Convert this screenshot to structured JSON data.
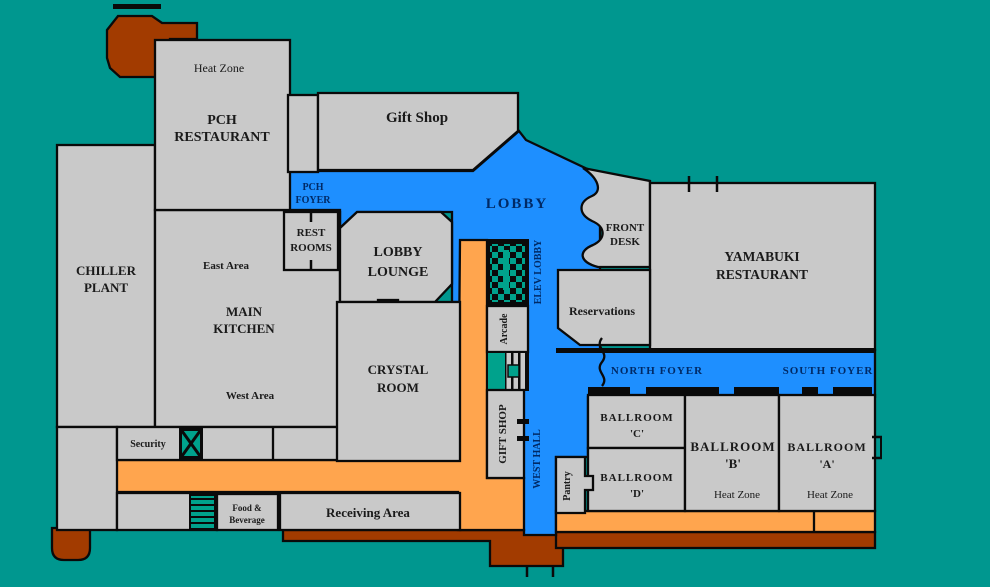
{
  "plan": {
    "type": "hotel-floor-plan",
    "colors": {
      "background": "#00978F",
      "room_gray": "#C9C9C9",
      "lobby_blue": "#1E8FFF",
      "corridor_orange": "#FFA54E",
      "service_red": "#A23B00",
      "icon_teal": "#00A28C",
      "wall_black": "#0a0a0a",
      "label_dark": "#1a1a1a",
      "label_navy": "#002A66"
    },
    "labels": {
      "heat_zone_pch": "Heat Zone",
      "pch_restaurant_1": "PCH",
      "pch_restaurant_2": "RESTAURANT",
      "gift_shop": "Gift Shop",
      "chiller_1": "CHILLER",
      "chiller_2": "PLANT",
      "east_area": "East Area",
      "main_kitchen_1": "MAIN",
      "main_kitchen_2": "KITCHEN",
      "west_area": "West Area",
      "pch_foyer_1": "PCH",
      "pch_foyer_2": "FOYER",
      "rest_rooms_1": "REST",
      "rest_rooms_2": "ROOMS",
      "lobby_lounge_1": "LOBBY",
      "lobby_lounge_2": "LOUNGE",
      "crystal_1": "CRYSTAL",
      "crystal_2": "ROOM",
      "lobby": "LOBBY",
      "front_desk_1": "FRONT",
      "front_desk_2": "DESK",
      "yamabuki_1": "YAMABUKI",
      "yamabuki_2": "RESTAURANT",
      "reservations": "Reservations",
      "elev_lobby": "ELEV LOBBY",
      "arcade": "Arcade",
      "gift_shop_v": "GIFT SHOP",
      "west_hall": "WEST HALL",
      "north_foyer": "NORTH FOYER",
      "south_foyer": "SOUTH FOYER",
      "ballroom_c_1": "BALLROOM",
      "ballroom_c_2": "'C'",
      "ballroom_d_1": "BALLROOM",
      "ballroom_d_2": "'D'",
      "ballroom_b_1": "BALLROOM",
      "ballroom_b_2": "'B'",
      "heat_zone_b": "Heat Zone",
      "ballroom_a_1": "BALLROOM",
      "ballroom_a_2": "'A'",
      "heat_zone_a": "Heat Zone",
      "pantry": "Pantry",
      "security": "Security",
      "food_bev_1": "Food &",
      "food_bev_2": "Beverage",
      "receiving": "Receiving Area"
    }
  }
}
